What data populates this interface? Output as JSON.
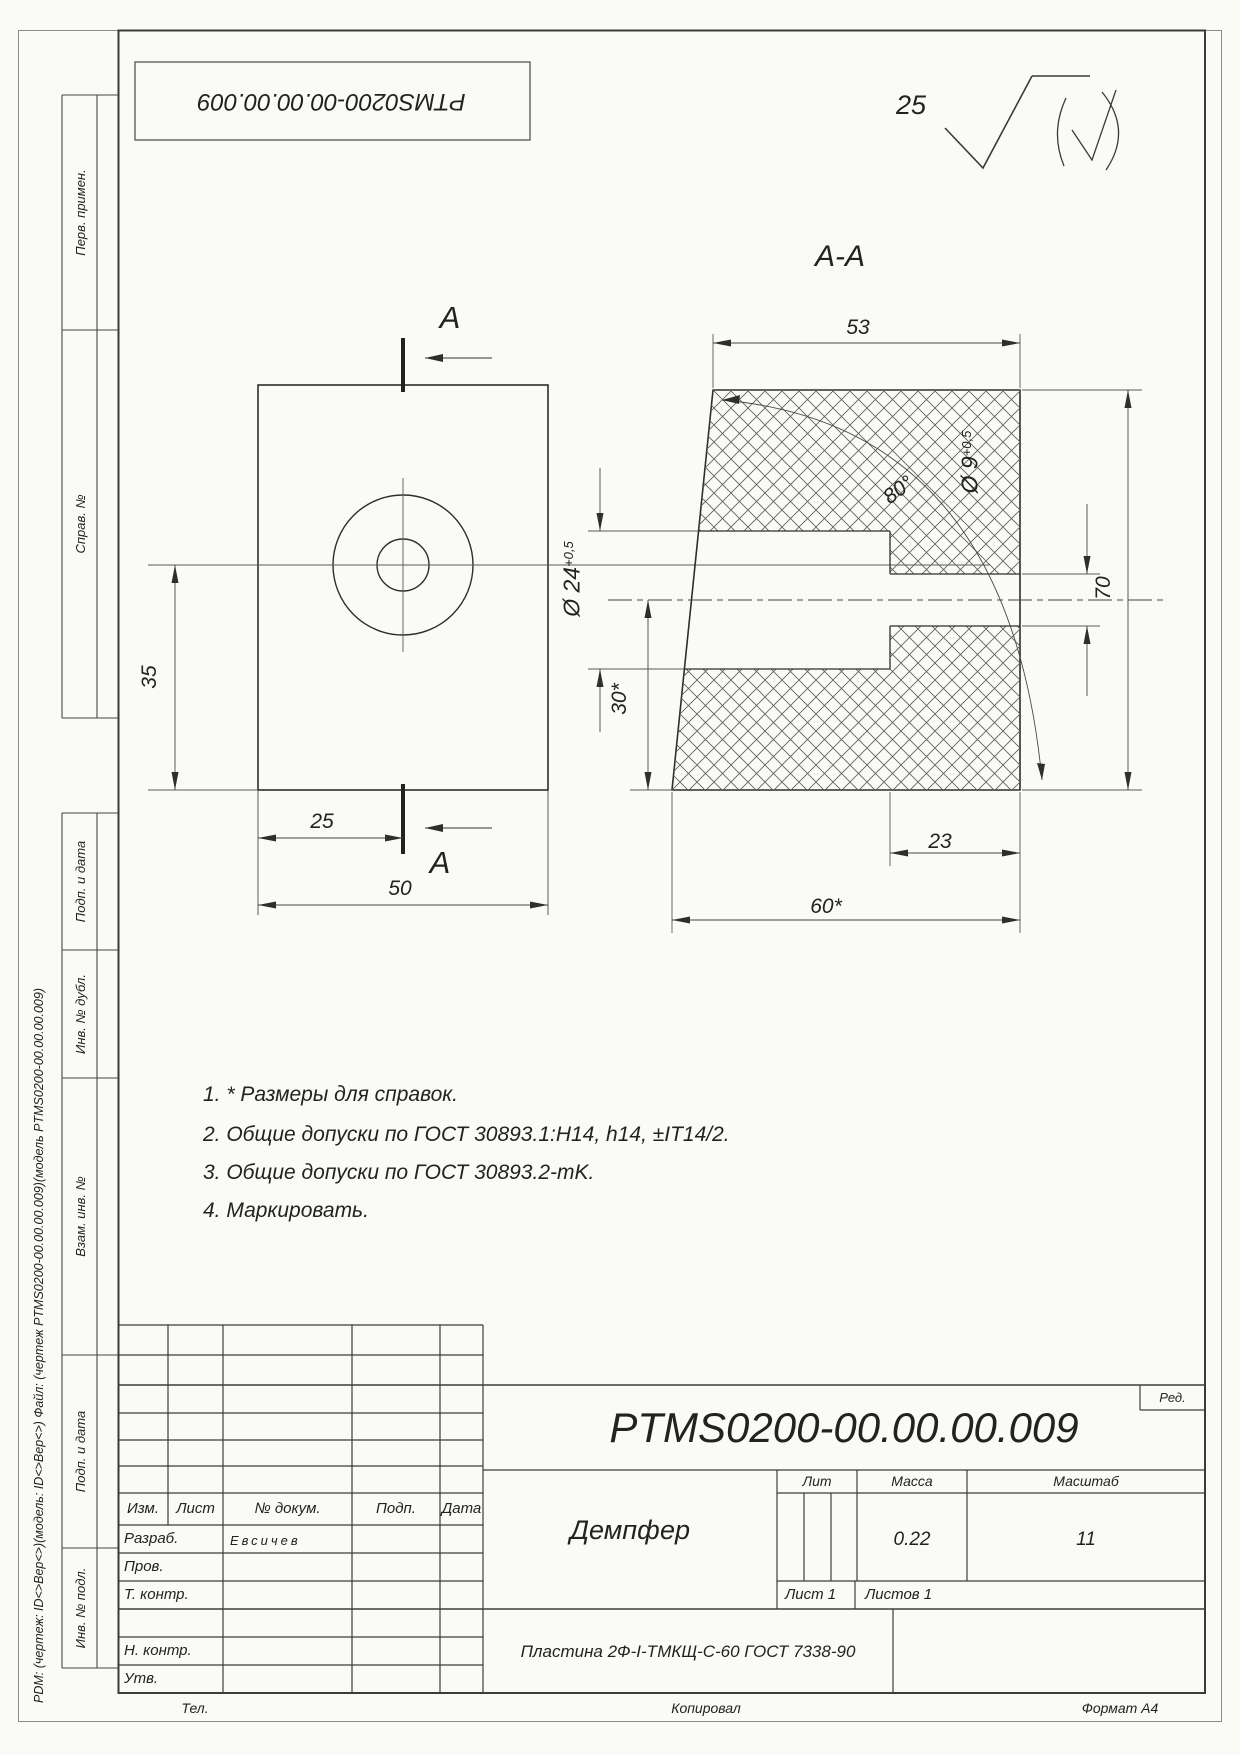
{
  "stamp_top": {
    "designation": "PTMS0200-00.00.00.009"
  },
  "roughness": {
    "value": "25"
  },
  "side_stamp": {
    "pdm": "PDM: (чертеж: ID<>Вер<>)(модель: ID<>Вер<>) Файл: (чертеж PTMS0200-00.00.00.009)(модель PTMS0200-00.00.00.009)",
    "cells": [
      "Перв. примен.",
      "Справ. №",
      "Подп. и дата",
      "Инв. № дубл.",
      "Взам. инв. №",
      "Подп. и дата",
      "Инв. № подл."
    ]
  },
  "views": {
    "front": {
      "cut_label_top": "A",
      "cut_label_bottom": "A",
      "dim_height": "35",
      "dim_offset": "25",
      "dim_width": "50"
    },
    "section": {
      "title": "A-A",
      "dim_top": "53",
      "dim_angle": "80°",
      "bore_large": "Ø 24",
      "bore_large_tol": "+0,5",
      "bore_small": "Ø 9",
      "bore_small_tol": "+0,5",
      "dim_height": "70",
      "dim_axis": "30*",
      "dim_small_len": "23",
      "dim_bottom": "60*"
    }
  },
  "notes": [
    "1. * Размеры для справок.",
    "2. Общие допуски по ГОСТ 30893.1:H14, h14,  ±IT14/2.",
    "3. Общие допуски по ГОСТ 30893.2-mK.",
    "4. Маркировать."
  ],
  "title_block": {
    "designation": "PTMS0200-00.00.00.009",
    "revision_label": "Ред.",
    "part_name": "Демпфер",
    "material": "Пластина 2Ф-I-ТМКЩ-С-60 ГОСТ 7338-90",
    "col_izm": "Изм.",
    "col_list": "Лист",
    "col_doc": "№ докум.",
    "col_sign": "Подп.",
    "col_date": "Дата",
    "row_razrab": "Разраб.",
    "row_prov": "Пров.",
    "row_tkontr": "Т. контр.",
    "row_nkontr": "Н. контр.",
    "row_utv": "Утв.",
    "razrab_value": "Евсичев",
    "lit_label": "Лит",
    "mass_label": "Масса",
    "scale_label": "Масштаб",
    "mass_value": "0.22",
    "scale_value": "11",
    "sheet_label": "Лист 1",
    "sheets_label": "Листов 1"
  },
  "footer": {
    "tel": "Тел.",
    "copied": "Копировал",
    "format": "Формат А4"
  }
}
